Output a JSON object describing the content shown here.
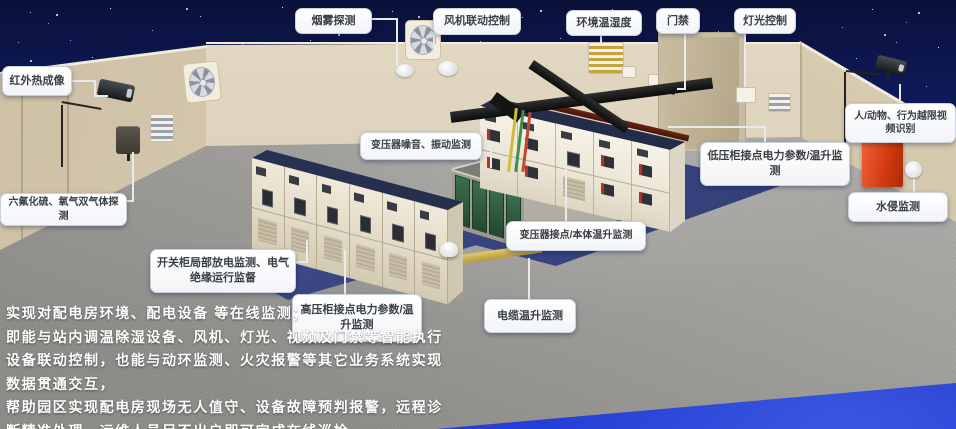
{
  "callouts": [
    "红外热成像",
    "烟雾探测",
    "风机联动控制",
    "环境温湿度",
    "门禁",
    "灯光控制",
    "人/动物、行为越限视频识别",
    "水侵监测",
    "六氟化硫、氧气双气体探测",
    "变压器噪音、振动监测",
    "低压柜接点电力参数/温升监测",
    "变压器接点/本体温升监测",
    "开关柜局部放电监测、电气绝缘运行监督",
    "高压柜接点电力参数/温升监测",
    "电缆温升监测"
  ],
  "description": {
    "lines": [
      "实现对配电房环境、配电设备 等在线监测；",
      "即能与站内调温除湿设备、风机、灯光、视频及门禁等智能执行",
      "设备联动控制，也能与动环监测、火灾报警等其它业务系统实现",
      "数据贯通交互，",
      "帮助园区实现配电房现场无人值守、设备故障预判报警，远程诊",
      "断精准处理，运维人员足不出户即可完成在线巡检。"
    ]
  },
  "colors": {
    "sky_top": "#0a1138",
    "sky_blue": "#2036c4",
    "wall_beige": "#d9cfb8",
    "floor_gray": "#a3a29f",
    "pad_blue": "#3a4784",
    "cabinet_roof_navy": "#27304f",
    "transformer_green": "#2e5a3c",
    "alarm_red": "#d43c10",
    "duct_yellow": "#c9ad4e",
    "callout_bg": "#ffffff",
    "callout_text": "#3b4046",
    "leader_line": "#e9eaec"
  }
}
